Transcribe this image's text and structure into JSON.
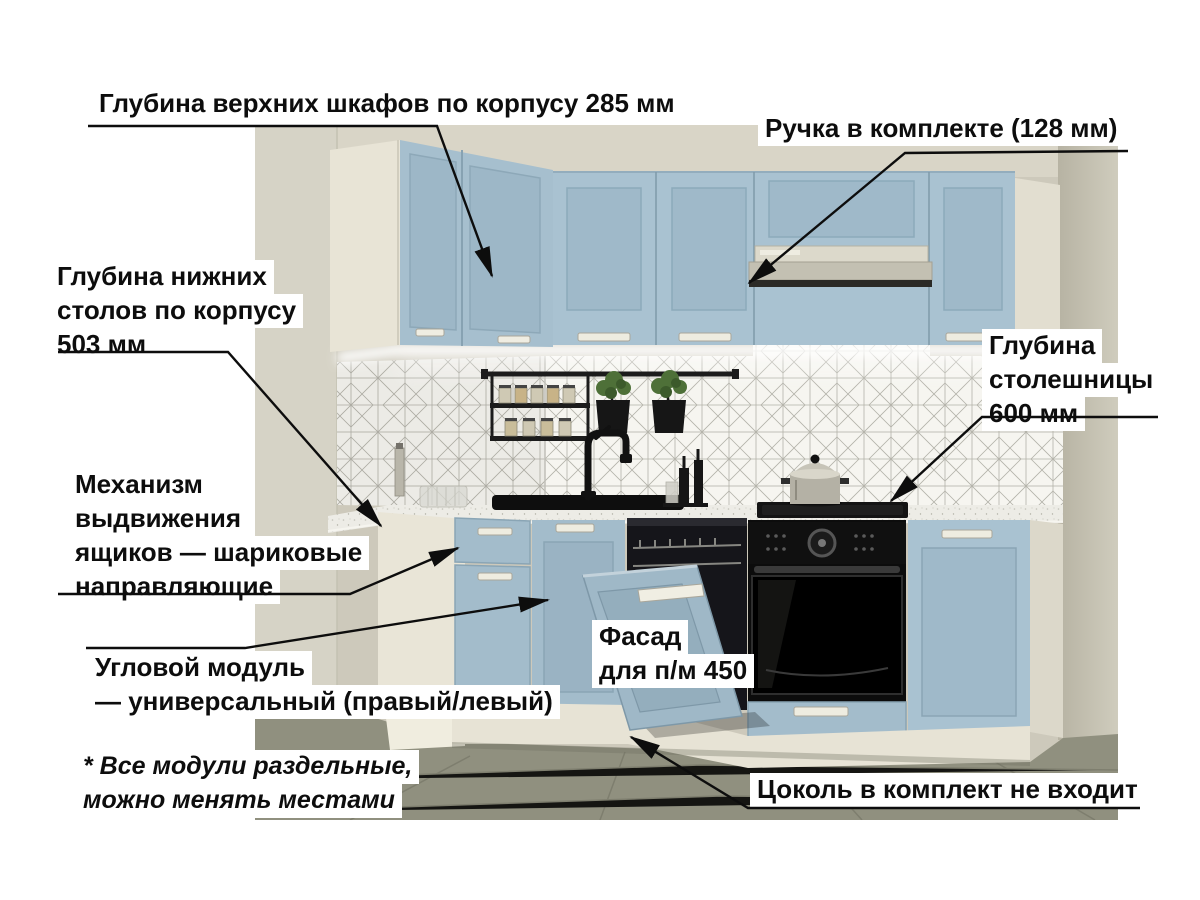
{
  "figure": {
    "type": "annotated-kitchen-render",
    "colors": {
      "cabinet_blue": "#a9c2d1",
      "wall_beige": "#cdc9bb",
      "counter_white": "#edece6",
      "floor_grey": "#90907f",
      "label_bg": "#ffffff",
      "label_text": "#0d0d0d",
      "arrow": "#0d0d0d"
    }
  },
  "annotations": {
    "upper_cabinet_depth": {
      "text": "Глубина верхних шкафов по корпусу 285 мм"
    },
    "handle_included": {
      "text": "Ручка в комплекте (128 мм)"
    },
    "base_cabinet_depth": {
      "lines": [
        "Глубина нижних",
        "столов по корпусу",
        "503 мм"
      ]
    },
    "countertop_depth": {
      "lines": [
        "Глубина",
        "столешницы",
        "600 мм"
      ]
    },
    "drawer_mechanism": {
      "lines": [
        "Механизм",
        "выдвижения",
        "ящиков — шариковые",
        "направляющие"
      ]
    },
    "corner_module": {
      "lines": [
        "Угловой модуль",
        "— универсальный (правый/левый)"
      ]
    },
    "modules_note": {
      "lines": [
        "* Все модули раздельные,",
        "можно менять местами"
      ]
    },
    "dishwasher_facade": {
      "lines": [
        "Фасад",
        "для п/м 450"
      ]
    },
    "plinth_note": {
      "text": "Цоколь в комплект не входит"
    }
  }
}
